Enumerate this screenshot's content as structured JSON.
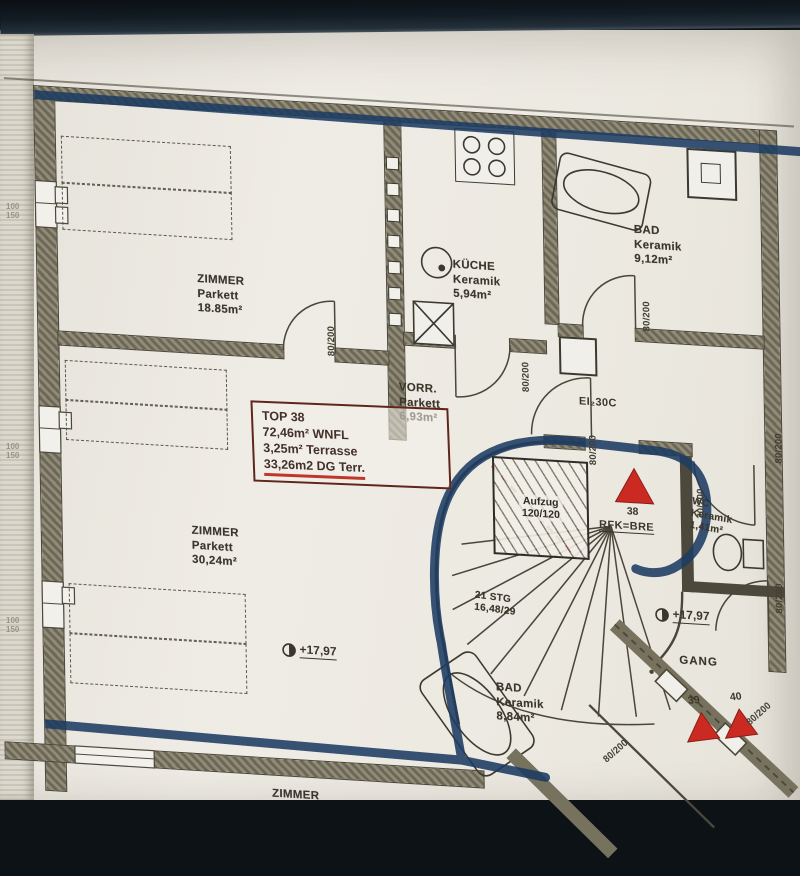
{
  "photo": {
    "paper_color": "#ece9e1",
    "band_color": "#131c24",
    "marker_color": "#1d3b62",
    "accent_red": "#c42a22",
    "wall_color": "#6d6856"
  },
  "unit_box": {
    "line1": "TOP 38",
    "line2": "72,46m² WNFL",
    "line3": "3,25m² Terrasse",
    "line4": "33,26m2 DG Terr."
  },
  "rooms": {
    "zimmer1": {
      "name": "ZIMMER",
      "floor": "Parkett",
      "area": "18.85m²"
    },
    "kueche": {
      "name": "KÜCHE",
      "floor": "Keramik",
      "area": "5,94m²"
    },
    "bad1": {
      "name": "BAD",
      "floor": "Keramik",
      "area": "9,12m²"
    },
    "vorraum": {
      "name": "VORR.",
      "floor": "Parkett",
      "area": "6,93m²"
    },
    "zimmer2": {
      "name": "ZIMMER",
      "floor": "Parkett",
      "area": "30,24m²"
    },
    "wc": {
      "name": "WC",
      "floor": "Keramik",
      "area": "1,41m²"
    },
    "bad2": {
      "name": "BAD",
      "floor": "Keramik",
      "area": "8,84m²"
    },
    "gang": {
      "name": "GANG"
    },
    "zimmer3": {
      "name": "ZIMMER"
    }
  },
  "stair": {
    "line1": "21 STG",
    "line2": "16,48/29"
  },
  "elevator": {
    "line1": "Aufzug",
    "line2": "120/120"
  },
  "levels": {
    "room": "+17,97",
    "corridor": "+17,97"
  },
  "doors": {
    "standard": "80/200",
    "wc": "70/200",
    "fire": "EI₂30C"
  },
  "apartments": {
    "a38": "38",
    "a39": "39",
    "a40": "40"
  },
  "annotations": {
    "rfk": "RFK=BRE"
  },
  "margin_dims": {
    "w": "100",
    "h": "150"
  }
}
